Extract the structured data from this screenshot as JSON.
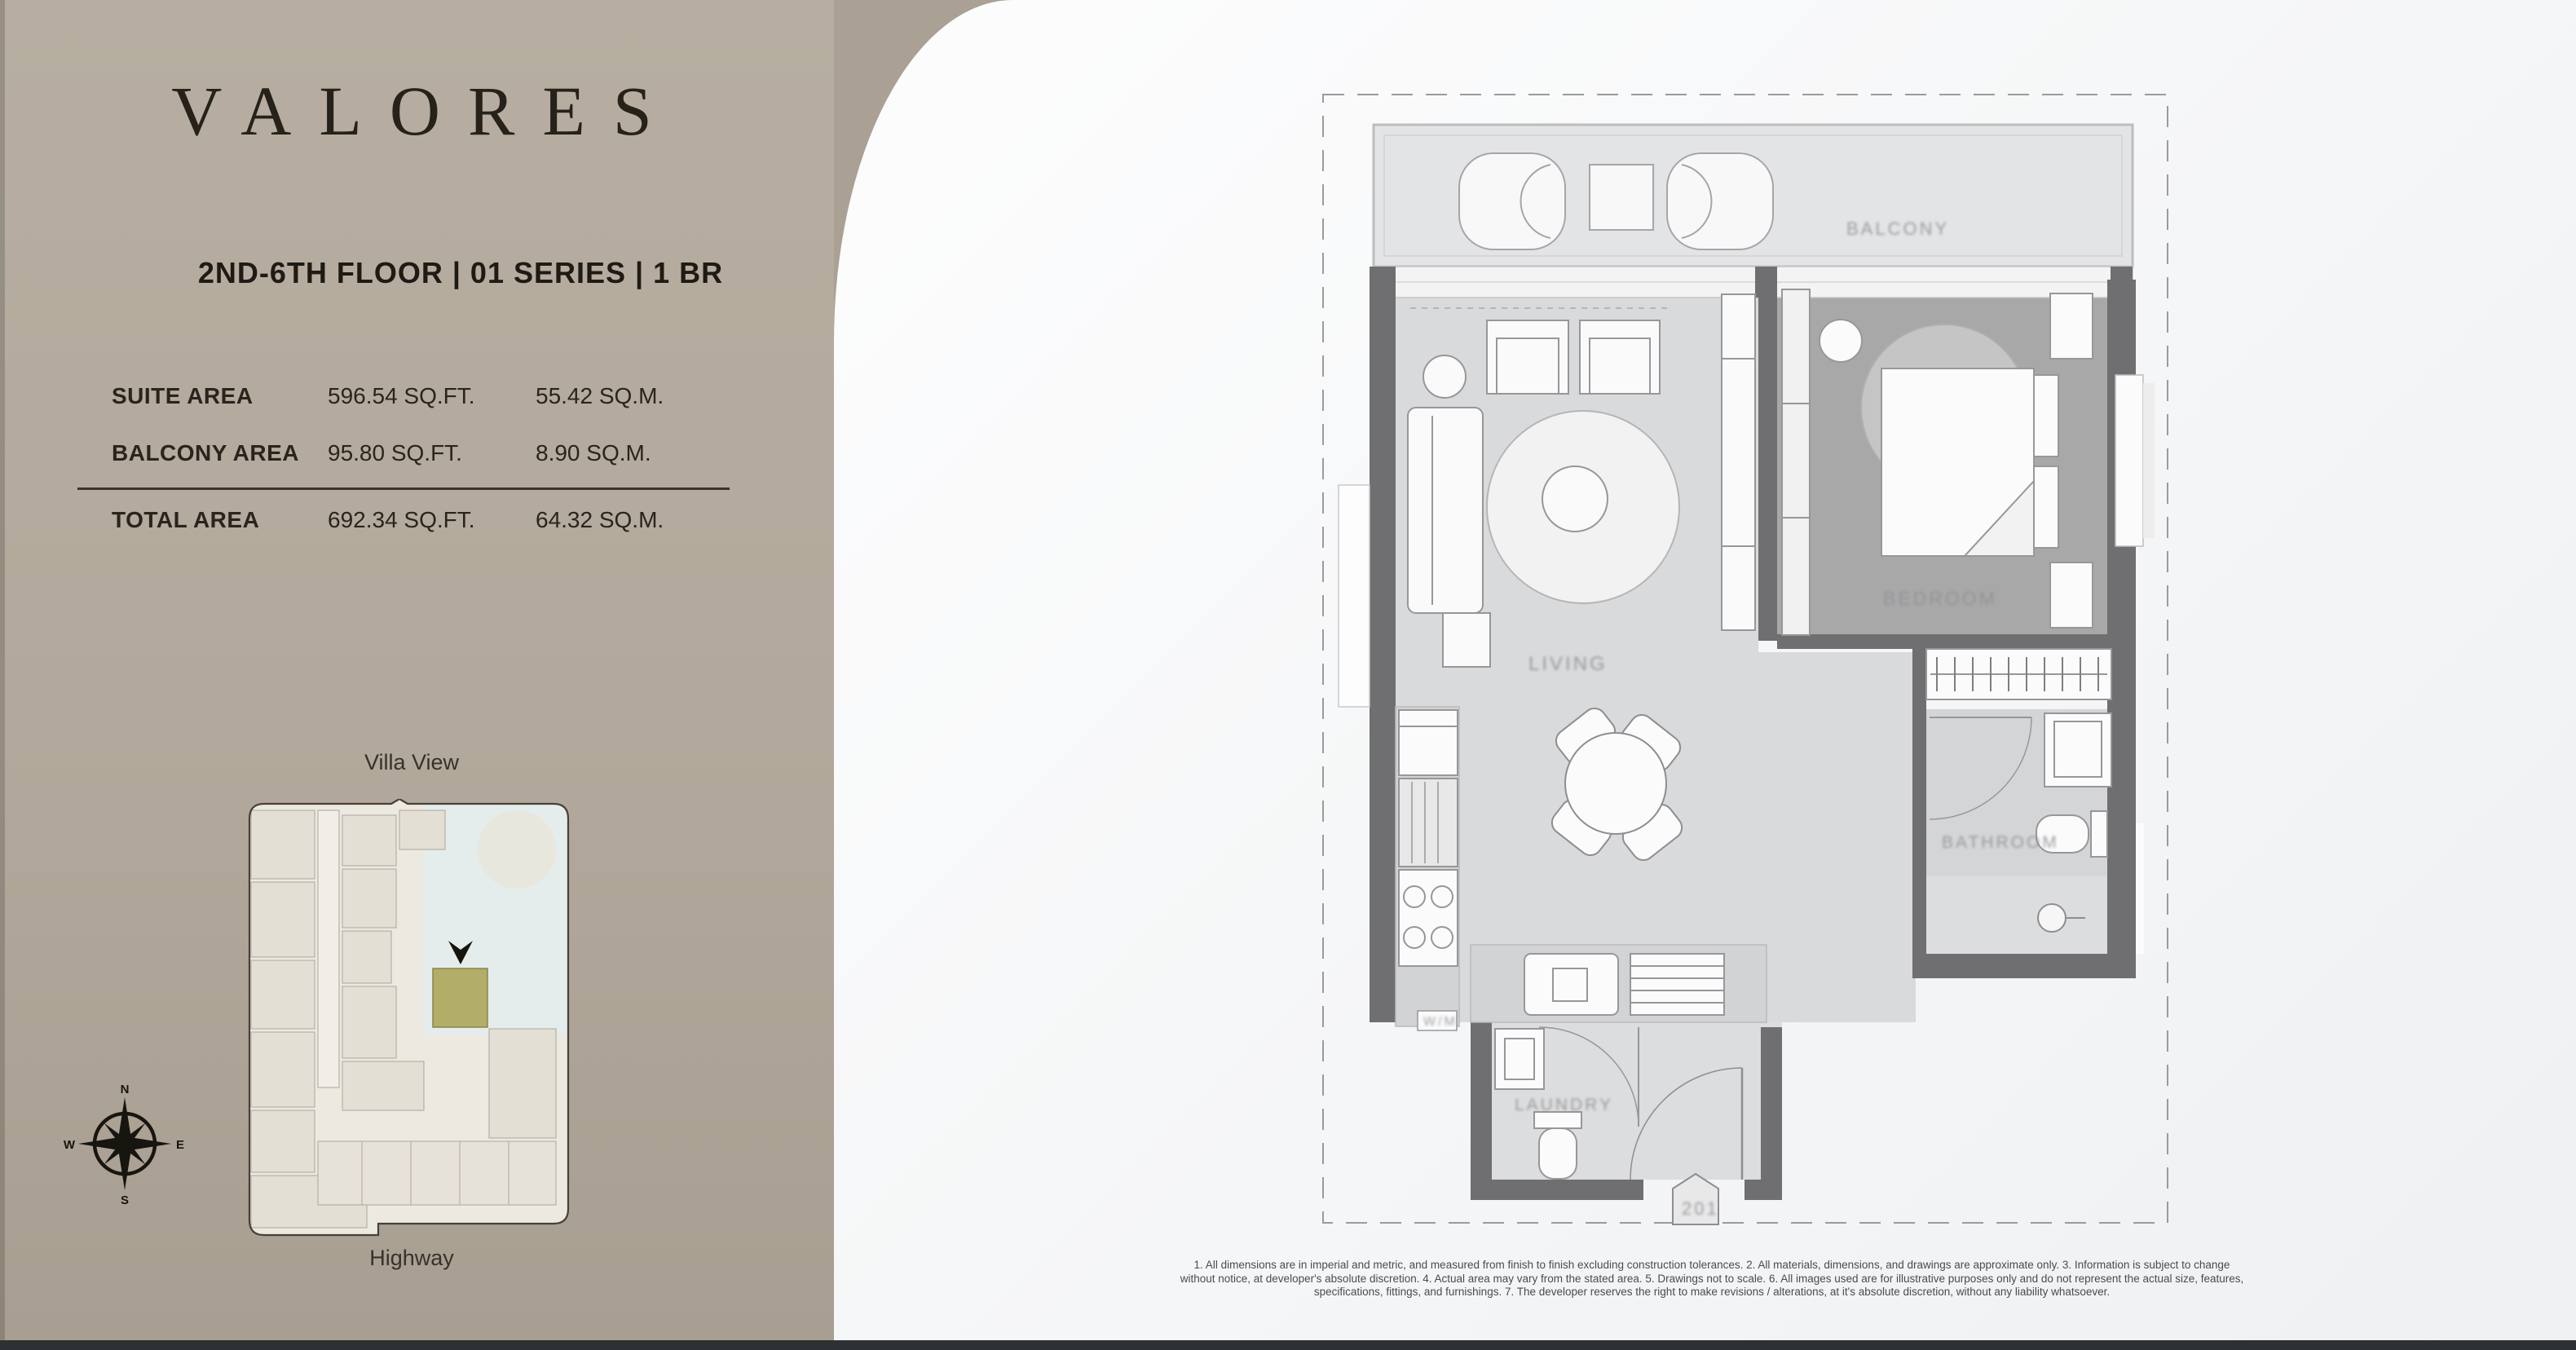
{
  "colors": {
    "left_panel_taupe": "#b2a89b",
    "right_panel_white": "#f6f7f8",
    "wall_gray": "#6f6e70",
    "bedroom_floor": "#a9a8a9",
    "living_floor": "#d9dadb",
    "balcony_floor": "#e3e4e5",
    "keyplan_highlight_olive": "#b2ad68",
    "text_dark": "#26211b",
    "bottom_bar": "#2d3134"
  },
  "brand": {
    "logo": "VALORES"
  },
  "unit": {
    "header": "2ND-6TH FLOOR | 01 SERIES | 1 BR"
  },
  "areas": {
    "rows": [
      {
        "label": "SUITE AREA",
        "imperial": "596.54 SQ.FT.",
        "metric": "55.42 SQ.M."
      },
      {
        "label": "BALCONY AREA",
        "imperial": "95.80 SQ.FT.",
        "metric": "8.90 SQ.M."
      },
      {
        "label": "TOTAL AREA",
        "imperial": "692.34 SQ.FT.",
        "metric": "64.32 SQ.M."
      }
    ]
  },
  "key_plan": {
    "view_label": "Villa View",
    "road_label": "Highway",
    "compass": {
      "n": "N",
      "e": "E",
      "s": "S",
      "w": "W"
    }
  },
  "plan": {
    "labels": {
      "balcony": "BALCONY",
      "living": "LIVING",
      "bedroom": "BEDROOM",
      "bathroom": "BATHROOM",
      "laundry": "LAUNDRY",
      "entry_tag": "201",
      "utility_tag": "W/M"
    }
  },
  "disclaimer": {
    "line1": "1. All dimensions are in imperial and metric, and measured from finish to finish excluding construction tolerances. 2. All materials, dimensions, and drawings are approximate only. 3. Information is subject to change",
    "line2": "without notice, at developer's absolute discretion. 4. Actual area may vary from the stated area. 5. Drawings not to scale. 6. All images used are for illustrative purposes only and do not represent the actual size, features,",
    "line3": "specifications, fittings, and furnishings. 7. The developer reserves the right to make revisions / alterations, at it's absolute discretion, without any liability whatsoever."
  }
}
